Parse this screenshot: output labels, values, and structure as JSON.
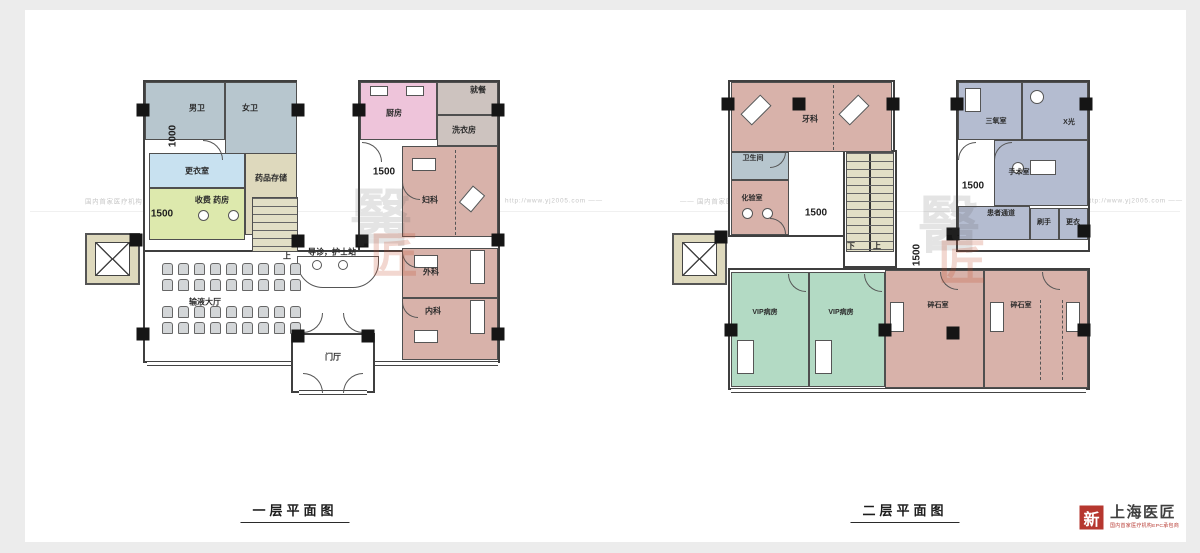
{
  "palette": {
    "rose": "#d8b2aa",
    "bluegray": "#b7c6ce",
    "lavender": "#b4bcd0",
    "ltblue": "#c8e1f0",
    "green": "#b3dac4",
    "pink": "#eec4da",
    "yellowgreen": "#dde9ad",
    "khaki": "#ded9bd",
    "graybrown": "#cdc3bf",
    "stair": "#e2dfc6",
    "white": "#ffffff"
  },
  "watermark": {
    "items": [
      "国内首家医疗机构EPC承包商",
      "http://www.yj2005.com ——",
      "—— 国内首家医疗机构EPC承包商",
      "http://www.yj2005.com ——"
    ],
    "seal_top": "醫",
    "seal_bottom": "匠"
  },
  "logo": {
    "mark": "新",
    "title": "上海医匠",
    "subtitle": "国内首家医疗机构EPC承包商"
  },
  "plans": [
    {
      "title": "一层平面图",
      "title_x": 295,
      "title_y": 500,
      "seal": {
        "x": 350,
        "y": 188
      },
      "shells": [
        {
          "x": 143,
          "y": 80,
          "w": 154,
          "h": 172
        },
        {
          "x": 358,
          "y": 80,
          "w": 142,
          "h": 172
        },
        {
          "x": 143,
          "y": 250,
          "w": 357,
          "h": 113
        },
        {
          "x": 291,
          "y": 333,
          "w": 84,
          "h": 60
        }
      ],
      "rooms": [
        {
          "id": "mens-toilet",
          "label": "男卫",
          "x": 145,
          "y": 82,
          "w": 80,
          "h": 58,
          "f": "bluegray",
          "lx": 197,
          "ly": 108,
          "fs": 8
        },
        {
          "id": "womens-toilet",
          "label": "女卫",
          "x": 225,
          "y": 82,
          "w": 72,
          "h": 73,
          "f": "bluegray",
          "lx": 250,
          "ly": 108,
          "fs": 8
        },
        {
          "id": "changing-room",
          "label": "更衣室",
          "x": 149,
          "y": 153,
          "w": 96,
          "h": 35,
          "f": "ltblue",
          "fs": 8
        },
        {
          "id": "medicine-storage",
          "label": "药品存储",
          "x": 245,
          "y": 153,
          "w": 52,
          "h": 82,
          "f": "khaki",
          "lx": 271,
          "ly": 178,
          "fs": 8
        },
        {
          "id": "cashier-pharmacy",
          "label": "收费 药房",
          "x": 149,
          "y": 188,
          "w": 96,
          "h": 52,
          "f": "yellowgreen",
          "lx": 212,
          "ly": 200,
          "fs": 8
        },
        {
          "id": "kitchen",
          "label": "厨房",
          "x": 360,
          "y": 82,
          "w": 77,
          "h": 58,
          "f": "pink",
          "lx": 394,
          "ly": 113,
          "fs": 8
        },
        {
          "id": "dining",
          "label": "就餐",
          "x": 437,
          "y": 82,
          "w": 61,
          "h": 33,
          "f": "graybrown",
          "lx": 478,
          "ly": 90,
          "fs": 8
        },
        {
          "id": "laundry",
          "label": "洗衣房",
          "x": 437,
          "y": 115,
          "w": 61,
          "h": 31,
          "f": "graybrown",
          "lx": 464,
          "ly": 130,
          "fs": 8
        },
        {
          "id": "gynecology",
          "label": "妇科",
          "x": 402,
          "y": 146,
          "w": 96,
          "h": 91,
          "f": "rose",
          "lx": 430,
          "ly": 200,
          "fs": 8
        },
        {
          "id": "surgery-dept",
          "label": "外科",
          "x": 402,
          "y": 248,
          "w": 96,
          "h": 50,
          "f": "rose",
          "lx": 431,
          "ly": 272,
          "fs": 8
        },
        {
          "id": "internal-medicine",
          "label": "内科",
          "x": 402,
          "y": 298,
          "w": 96,
          "h": 62,
          "f": "rose",
          "lx": 433,
          "ly": 311,
          "fs": 8
        }
      ],
      "stairs": [
        {
          "x": 252,
          "y": 197,
          "w": 46,
          "h": 55,
          "rail": false
        }
      ],
      "elevators": [
        {
          "x": 85,
          "y": 233,
          "w": 55,
          "h": 52
        }
      ],
      "counters": [
        {
          "x": 297,
          "y": 256,
          "w": 82,
          "h": 32
        }
      ],
      "chairs": [
        {
          "x": 162,
          "y": 263,
          "cols": 9,
          "rows": 2,
          "cw": 11,
          "ch": 12,
          "gx": 5,
          "gy": 4
        },
        {
          "x": 162,
          "y": 306,
          "cols": 9,
          "rows": 2,
          "cw": 11,
          "ch": 12,
          "gx": 5,
          "gy": 4
        }
      ],
      "windows": [
        {
          "x": 147,
          "y": 361,
          "w": 144
        },
        {
          "x": 375,
          "y": 361,
          "w": 123
        },
        {
          "x": 299,
          "y": 390,
          "w": 68
        }
      ],
      "dims": [
        {
          "t": "1000",
          "x": 173,
          "y": 136,
          "v": true
        },
        {
          "t": "1500",
          "x": 162,
          "y": 214
        },
        {
          "t": "1500",
          "x": 384,
          "y": 172
        }
      ],
      "notes": [
        {
          "t": "上",
          "x": 287,
          "y": 256,
          "fs": 8
        },
        {
          "t": "导诊，护士站",
          "x": 332,
          "y": 252,
          "fs": 8
        },
        {
          "t": "输液大厅",
          "x": 205,
          "y": 302,
          "fs": 8
        },
        {
          "t": "门厅",
          "x": 333,
          "y": 357,
          "fs": 8
        }
      ],
      "furn": [
        {
          "x": 198,
          "y": 210,
          "w": 11,
          "h": 11,
          "shape": "circle"
        },
        {
          "x": 228,
          "y": 210,
          "w": 11,
          "h": 11,
          "shape": "circle"
        },
        {
          "x": 312,
          "y": 260,
          "w": 10,
          "h": 10,
          "shape": "circle"
        },
        {
          "x": 338,
          "y": 260,
          "w": 10,
          "h": 10,
          "shape": "circle"
        },
        {
          "x": 412,
          "y": 158,
          "w": 24,
          "h": 13
        },
        {
          "x": 464,
          "y": 188,
          "w": 16,
          "h": 22,
          "rot": 40
        },
        {
          "x": 414,
          "y": 255,
          "w": 24,
          "h": 13
        },
        {
          "x": 470,
          "y": 250,
          "w": 15,
          "h": 34
        },
        {
          "x": 414,
          "y": 330,
          "w": 24,
          "h": 13
        },
        {
          "x": 470,
          "y": 300,
          "w": 15,
          "h": 34
        },
        {
          "x": 370,
          "y": 86,
          "w": 18,
          "h": 10
        },
        {
          "x": 406,
          "y": 86,
          "w": 18,
          "h": 10
        }
      ],
      "arcs": [
        {
          "x": 203,
          "y": 140,
          "r": 20,
          "c": "tr"
        },
        {
          "x": 362,
          "y": 142,
          "r": 20,
          "c": "tr"
        },
        {
          "x": 402,
          "y": 182,
          "r": 18,
          "c": "bl"
        },
        {
          "x": 402,
          "y": 252,
          "r": 16,
          "c": "bl"
        },
        {
          "x": 402,
          "y": 302,
          "r": 16,
          "c": "bl"
        },
        {
          "x": 303,
          "y": 313,
          "r": 20,
          "c": "br"
        },
        {
          "x": 343,
          "y": 313,
          "r": 20,
          "c": "bl"
        },
        {
          "x": 303,
          "y": 373,
          "r": 20,
          "c": "tr"
        },
        {
          "x": 343,
          "y": 373,
          "r": 20,
          "c": "tl"
        }
      ],
      "dashes": [
        {
          "x": 455,
          "y": 150,
          "h": 85
        }
      ],
      "cols": [
        [
          143,
          110
        ],
        [
          298,
          110
        ],
        [
          359,
          110
        ],
        [
          498,
          110
        ],
        [
          136,
          240
        ],
        [
          298,
          241
        ],
        [
          362,
          241
        ],
        [
          498,
          240
        ],
        [
          143,
          334
        ],
        [
          298,
          336
        ],
        [
          368,
          336
        ],
        [
          498,
          334
        ]
      ]
    },
    {
      "title": "二层平面图",
      "title_x": 905,
      "title_y": 500,
      "seal": {
        "x": 918,
        "y": 195
      },
      "shells": [
        {
          "x": 728,
          "y": 80,
          "w": 167,
          "h": 157
        },
        {
          "x": 956,
          "y": 80,
          "w": 134,
          "h": 172
        },
        {
          "x": 728,
          "y": 268,
          "w": 362,
          "h": 122
        },
        {
          "x": 843,
          "y": 150,
          "w": 54,
          "h": 118
        }
      ],
      "rooms": [
        {
          "id": "dental",
          "label": "牙科",
          "x": 731,
          "y": 82,
          "w": 161,
          "h": 70,
          "f": "rose",
          "lx": 810,
          "ly": 119,
          "fs": 8
        },
        {
          "id": "sanitary-room",
          "label": "卫生间",
          "x": 731,
          "y": 152,
          "w": 58,
          "h": 28,
          "f": "bluegray",
          "lx": 753,
          "ly": 158,
          "fs": 7
        },
        {
          "id": "lab",
          "label": "化验室",
          "x": 731,
          "y": 180,
          "w": 58,
          "h": 55,
          "f": "rose",
          "lx": 752,
          "ly": 198,
          "fs": 7
        },
        {
          "id": "ozone-room",
          "label": "三氧室",
          "x": 958,
          "y": 82,
          "w": 64,
          "h": 58,
          "f": "lavender",
          "lx": 996,
          "ly": 121,
          "fs": 7
        },
        {
          "id": "xray-room",
          "label": "X光",
          "x": 1022,
          "y": 82,
          "w": 66,
          "h": 58,
          "f": "lavender",
          "lx": 1069,
          "ly": 122,
          "fs": 7
        },
        {
          "id": "operating-room",
          "label": "手术室",
          "x": 994,
          "y": 140,
          "w": 94,
          "h": 66,
          "f": "lavender",
          "lx": 1019,
          "ly": 172,
          "fs": 7
        },
        {
          "id": "patient-corridor",
          "label": "患者通道",
          "x": 958,
          "y": 206,
          "w": 72,
          "h": 34,
          "f": "lavender",
          "lx": 1001,
          "ly": 213,
          "fs": 7
        },
        {
          "id": "scrub-room",
          "label": "刷手",
          "x": 1030,
          "y": 208,
          "w": 29,
          "h": 32,
          "f": "lavender",
          "lx": 1044,
          "ly": 222,
          "fs": 7
        },
        {
          "id": "locker-room",
          "label": "更衣",
          "x": 1059,
          "y": 208,
          "w": 29,
          "h": 32,
          "f": "lavender",
          "lx": 1073,
          "ly": 222,
          "fs": 7
        },
        {
          "id": "vip-ward-1",
          "label": "VIP病房",
          "x": 731,
          "y": 272,
          "w": 78,
          "h": 115,
          "f": "green",
          "lx": 765,
          "ly": 312,
          "fs": 7
        },
        {
          "id": "vip-ward-2",
          "label": "VIP病房",
          "x": 809,
          "y": 272,
          "w": 76,
          "h": 115,
          "f": "green",
          "lx": 841,
          "ly": 312,
          "fs": 7
        },
        {
          "id": "lithotripsy-1",
          "label": "碎石室",
          "x": 885,
          "y": 270,
          "w": 99,
          "h": 118,
          "f": "rose",
          "lx": 938,
          "ly": 305,
          "fs": 7
        },
        {
          "id": "lithotripsy-2",
          "label": "碎石室",
          "x": 984,
          "y": 270,
          "w": 104,
          "h": 118,
          "f": "rose",
          "lx": 1021,
          "ly": 305,
          "fs": 7
        }
      ],
      "stairs": [
        {
          "x": 846,
          "y": 152,
          "w": 48,
          "h": 100,
          "rail": true
        }
      ],
      "elevators": [
        {
          "x": 672,
          "y": 233,
          "w": 55,
          "h": 52
        }
      ],
      "counters": [],
      "chairs": [],
      "windows": [
        {
          "x": 731,
          "y": 388,
          "w": 355
        }
      ],
      "dims": [
        {
          "t": "1500",
          "x": 816,
          "y": 213
        },
        {
          "t": "1500",
          "x": 973,
          "y": 186
        },
        {
          "t": "1500",
          "x": 917,
          "y": 255,
          "v": true
        }
      ],
      "notes": [
        {
          "t": "下",
          "x": 851,
          "y": 246,
          "fs": 8
        },
        {
          "t": "上",
          "x": 877,
          "y": 246,
          "fs": 8
        }
      ],
      "furn": [
        {
          "x": 748,
          "y": 96,
          "w": 16,
          "h": 28,
          "rot": 45
        },
        {
          "x": 846,
          "y": 96,
          "w": 16,
          "h": 28,
          "rot": 45
        },
        {
          "x": 742,
          "y": 208,
          "w": 11,
          "h": 11,
          "shape": "circle"
        },
        {
          "x": 762,
          "y": 208,
          "w": 11,
          "h": 11,
          "shape": "circle"
        },
        {
          "x": 1030,
          "y": 160,
          "w": 26,
          "h": 15
        },
        {
          "x": 1012,
          "y": 162,
          "w": 12,
          "h": 12,
          "shape": "circle"
        },
        {
          "x": 965,
          "y": 88,
          "w": 16,
          "h": 24
        },
        {
          "x": 1030,
          "y": 90,
          "w": 14,
          "h": 14,
          "shape": "circle"
        },
        {
          "x": 737,
          "y": 340,
          "w": 17,
          "h": 34
        },
        {
          "x": 815,
          "y": 340,
          "w": 17,
          "h": 34
        },
        {
          "x": 890,
          "y": 302,
          "w": 14,
          "h": 30
        },
        {
          "x": 1066,
          "y": 302,
          "w": 14,
          "h": 30
        },
        {
          "x": 990,
          "y": 302,
          "w": 14,
          "h": 30
        }
      ],
      "arcs": [
        {
          "x": 770,
          "y": 152,
          "r": 16,
          "c": "br"
        },
        {
          "x": 770,
          "y": 218,
          "r": 16,
          "c": "tr"
        },
        {
          "x": 958,
          "y": 142,
          "r": 18,
          "c": "tl"
        },
        {
          "x": 994,
          "y": 142,
          "r": 18,
          "c": "tl"
        },
        {
          "x": 788,
          "y": 274,
          "r": 18,
          "c": "bl"
        },
        {
          "x": 864,
          "y": 274,
          "r": 18,
          "c": "bl"
        },
        {
          "x": 940,
          "y": 272,
          "r": 18,
          "c": "bl"
        },
        {
          "x": 1042,
          "y": 272,
          "r": 18,
          "c": "bl"
        }
      ],
      "dashes": [
        {
          "x": 833,
          "y": 85,
          "h": 65
        },
        {
          "x": 1040,
          "y": 300,
          "h": 80
        },
        {
          "x": 1062,
          "y": 300,
          "h": 80
        }
      ],
      "cols": [
        [
          728,
          104
        ],
        [
          799,
          104
        ],
        [
          893,
          104
        ],
        [
          957,
          104
        ],
        [
          1086,
          104
        ],
        [
          721,
          237
        ],
        [
          953,
          234
        ],
        [
          1084,
          231
        ],
        [
          731,
          330
        ],
        [
          885,
          330
        ],
        [
          953,
          333
        ],
        [
          1084,
          330
        ]
      ]
    }
  ]
}
